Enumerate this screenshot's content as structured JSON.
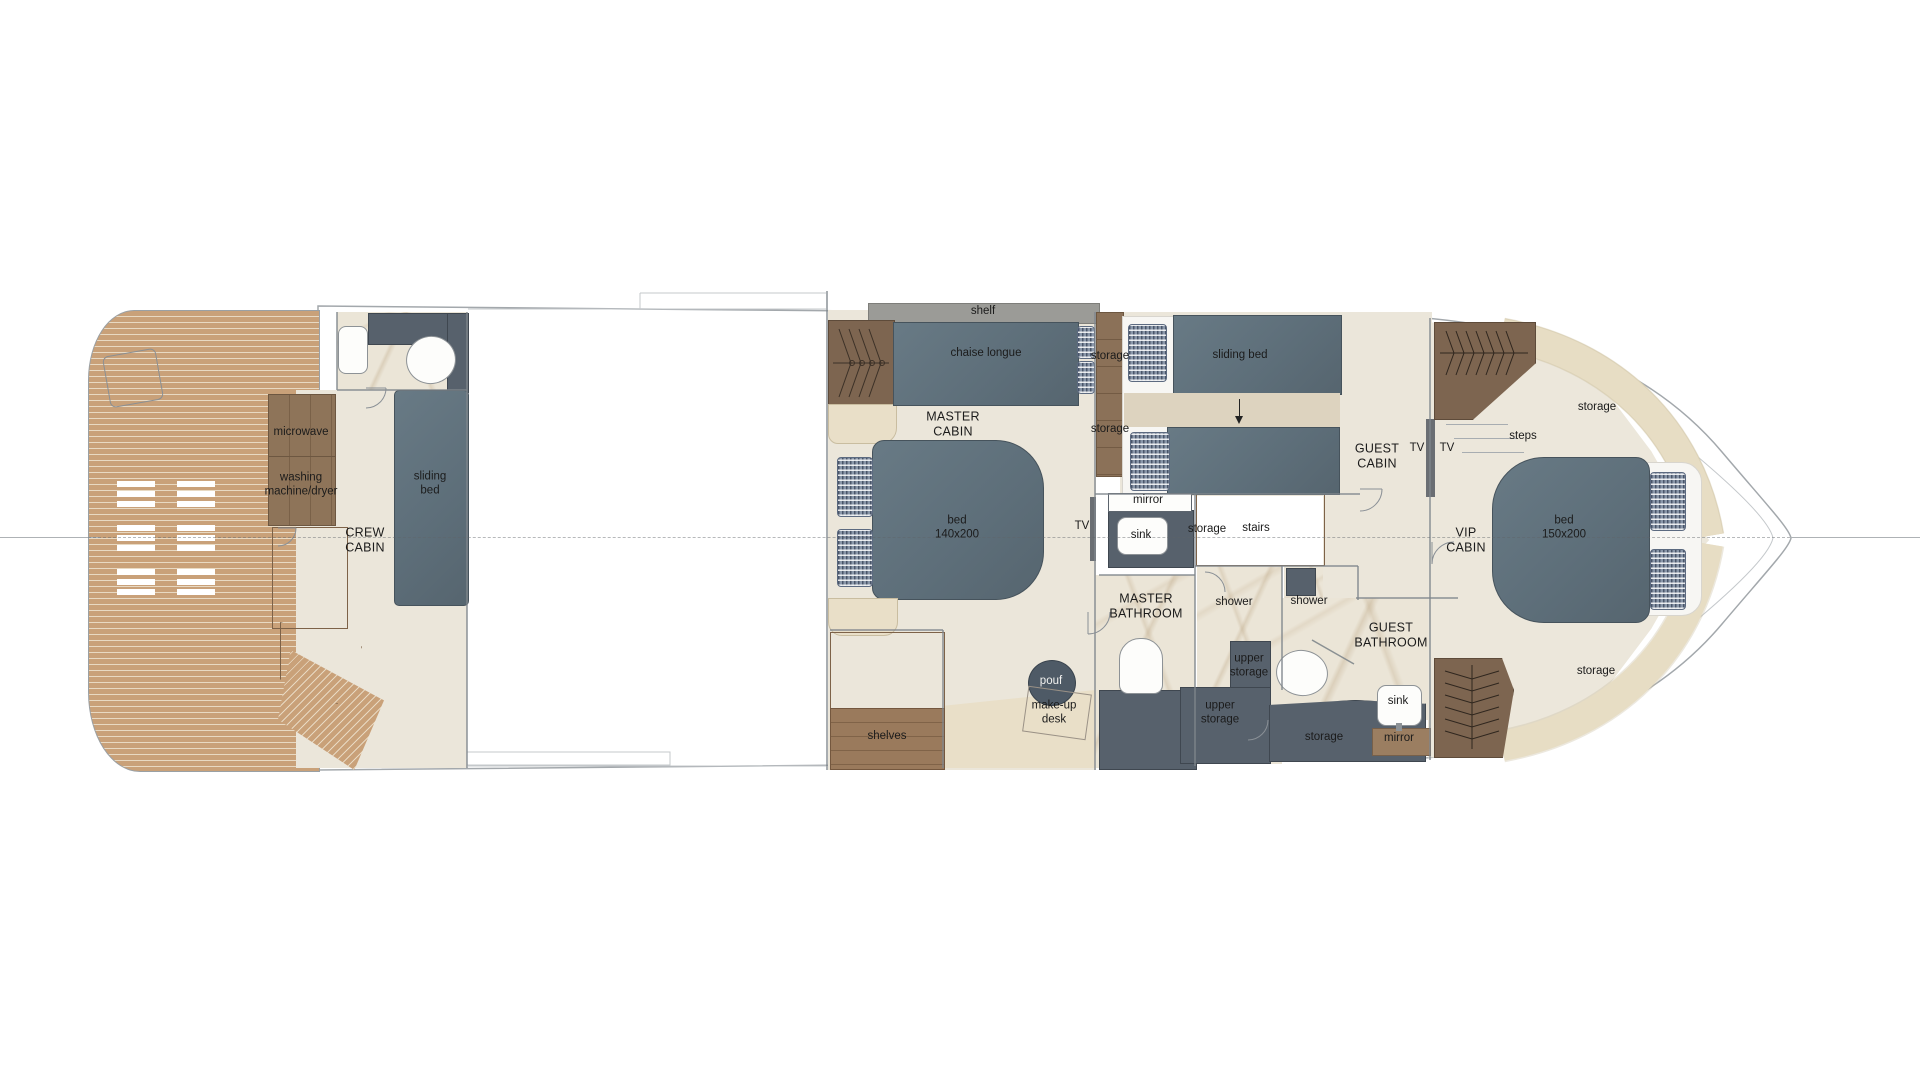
{
  "plan_type": "yacht lower deck floor plan",
  "colors": {
    "teak": "#c9a179",
    "cabinet_wood": "#8e7459",
    "stair_wood": "#a78b69",
    "upholstery_slate": "#5d6e79",
    "dark_slate": "#57616c",
    "cream_storage": "#e9dfc8",
    "carpet": "#ebe6da",
    "marble": "#ebe5d7",
    "pillow_blue": "#8a97a9",
    "outline": "#a3a8ac"
  },
  "rooms": {
    "crew_cabin": {
      "name": "CREW\nCABIN",
      "microwave": "microwave",
      "washing_machine": "washing\nmachine/dryer",
      "sliding_bed": "sliding\nbed"
    },
    "master_cabin": {
      "name": "MASTER\nCABIN",
      "shelf": "shelf",
      "chaise_longue": "chaise longue",
      "bed": "bed\n140x200",
      "tv": "TV",
      "storage_upper": "storage",
      "storage_lower": "storage"
    },
    "master_bathroom": {
      "name": "MASTER\nBATHROOM",
      "mirror": "mirror",
      "sink": "sink",
      "shower": "shower"
    },
    "stairs_area": {
      "storage": "storage",
      "stairs": "stairs",
      "pouf": "pouf",
      "makeup_desk": "make-up\ndesk",
      "shelves": "shelves"
    },
    "guest_cabin": {
      "name": "GUEST\nCABIN",
      "sliding_bed": "sliding bed",
      "tv_guest": "TV",
      "tv_vip": "TV"
    },
    "guest_bathroom": {
      "name": "GUEST\nBATHROOM",
      "shower": "shower",
      "upper_storage_fwd": "upper\nstorage",
      "upper_storage_aft": "upper\nstorage",
      "storage": "storage",
      "sink": "sink",
      "mirror": "mirror"
    },
    "vip_cabin": {
      "name": "VIP\nCABIN",
      "steps": "steps",
      "storage_top": "storage",
      "storage_bottom": "storage",
      "bed": "bed\n150x200"
    }
  }
}
